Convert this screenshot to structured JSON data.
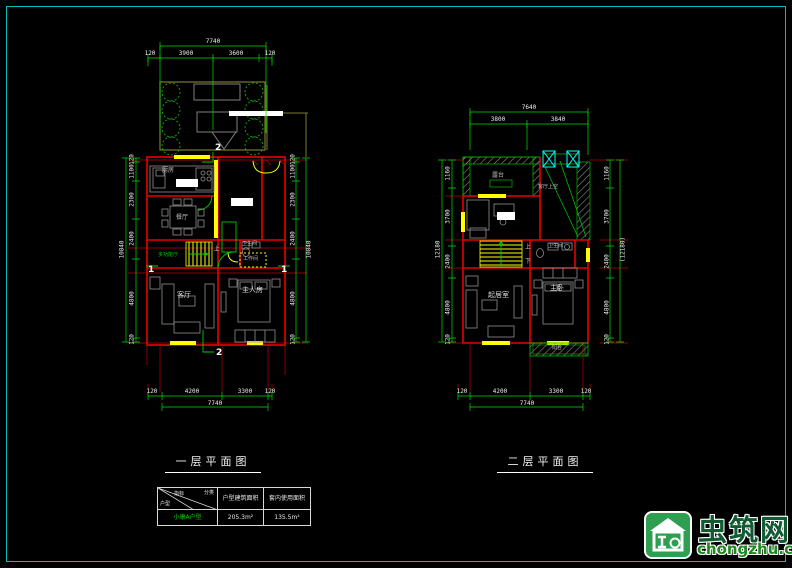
{
  "colors": {
    "frame": "#00bcbc",
    "wall": "#e80000",
    "axis": "#c00000",
    "dim": "#00dd00",
    "highlight": "#ffff00",
    "accent": "#00ffff",
    "furniture": "#8f8f8f",
    "garden": "#7a7c30",
    "tree": "#10a010",
    "logo_green": "#2e9e50"
  },
  "plan1": {
    "title": "一层平面图",
    "top": {
      "total": "7740",
      "segs": [
        "120",
        "3900",
        "3600",
        "120"
      ]
    },
    "bottom": {
      "total": "7740",
      "segs": [
        "120",
        "4200",
        "3300",
        "120"
      ]
    },
    "left": {
      "total": "10840",
      "segs": [
        "120",
        "1100",
        "2300",
        "2400",
        "4800",
        "120"
      ]
    },
    "right": {
      "total": "10840",
      "segs": [
        "120",
        "1100",
        "2300",
        "2400",
        "4800",
        "120"
      ]
    },
    "rooms": {
      "kitchen": "厨房",
      "dining": "餐厅",
      "multi": "多功能厅",
      "bath": "卫生间",
      "work": "工作间",
      "living": "客厅",
      "master": "主人房",
      "stair_up": "上"
    },
    "markers": {
      "s1": "1",
      "s2": "2"
    }
  },
  "plan2": {
    "title": "二层平面图",
    "top": {
      "total": "7640",
      "segs": [
        "3800",
        "3840"
      ]
    },
    "bottom": {
      "total": "7740",
      "segs": [
        "120",
        "4200",
        "3300",
        "120"
      ]
    },
    "left": {
      "total": "12180",
      "segs": [
        "1160",
        "3700",
        "2400",
        "4800",
        "120"
      ]
    },
    "right": {
      "total": "(12180)",
      "segs": [
        "1160",
        "3700",
        "2400",
        "4800",
        "120"
      ]
    },
    "rooms": {
      "terrace": "露台",
      "void": "客厅上空",
      "bath": "卫生间",
      "family": "起居室",
      "master": "主卧",
      "balcony": "阳台",
      "stair_up": "上",
      "stair_down": "下"
    }
  },
  "table": {
    "corner": {
      "a": "分类",
      "b": "指标",
      "c": "户型"
    },
    "headers": [
      "户型建筑面积",
      "套内使用面积"
    ],
    "row": {
      "name": "小康A户型",
      "v1": "205.3m²",
      "v2": "135.5m²"
    }
  },
  "logo": {
    "name": "虫筑网",
    "domain": "chongzhu.cn"
  }
}
